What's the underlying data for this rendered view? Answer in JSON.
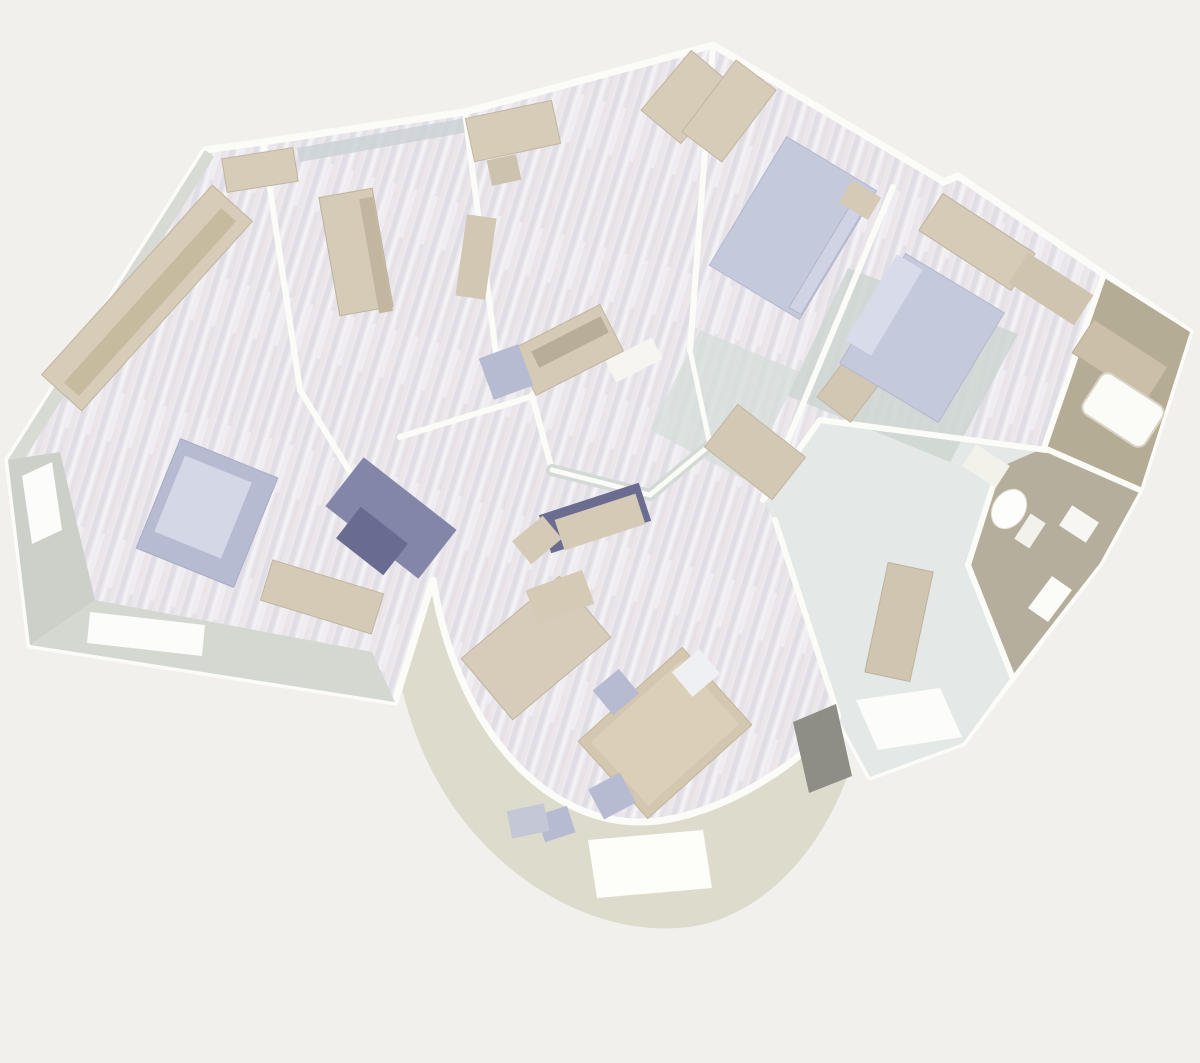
{
  "scene": {
    "label": "3D rendered bird's-eye floor plan of an apartment with curved terrace",
    "background": "#f2f0ec"
  },
  "palette": {
    "background": "#f2f0ec",
    "wall_white": "#fbfbf8",
    "wall_face_gray": "#ccd0c9",
    "wall_face_blue": "#c9d1d5",
    "floor_base": "#ebe9ed",
    "floor_streak_dark": "#e0dee4",
    "floor_streak_light": "#f3f2f5",
    "terrace_floor": "#dddbcc",
    "hall_floor": "#e4e8e6",
    "tile_taupe": "#b6ae9c",
    "furniture_beige": "#d7ccb8",
    "furniture_beige_dark": "#bfb4a0",
    "bed_lavender": "#c5c9dc",
    "bed_lavender_light": "#d8dbe9",
    "navy": "#8386a9",
    "navy_dark": "#696b90",
    "rug_green": "#ccd5cf",
    "fixture_white": "#fdfdfb",
    "door_gray": "#8e8e86"
  },
  "shapes": [
    {
      "n": "terrace-floor",
      "t": "path",
      "d": "M390,610 C398,712 430,793 495,855 C565,920 645,938 705,924 C765,908 818,856 848,775 L835,716 C788,772 705,820 640,820 C540,820 460,722 436,585 Z",
      "f": "#dddbcc"
    },
    {
      "n": "terrace-doormat",
      "t": "polygon",
      "pts": [
        [
          588,
          840
        ],
        [
          703,
          830
        ],
        [
          712,
          888
        ],
        [
          597,
          898
        ]
      ],
      "f": "#fdfdfa"
    },
    {
      "n": "building-footprint-floor",
      "t": "path",
      "d": "M8,460 L205,150 L263,142 L465,112 L713,45 L944,182 L958,176 L1190,332 L1140,490 L1100,563 L963,743 L870,777 L838,718 C790,775 705,822 640,822 C538,822 455,720 433,580 L395,702 L30,645 Z",
      "f": "url(#wood)",
      "s": "#fbfbf8",
      "sw": 7
    },
    {
      "n": "hallway-floor",
      "t": "polygon",
      "pts": [
        [
          820,
          420
        ],
        [
          1046,
          450
        ],
        [
          998,
          468
        ],
        [
          968,
          565
        ],
        [
          1012,
          676
        ],
        [
          963,
          743
        ],
        [
          870,
          777
        ],
        [
          838,
          718
        ],
        [
          780,
          530
        ],
        [
          763,
          500
        ]
      ],
      "f": "#e4e8e6"
    },
    {
      "n": "wc-floor",
      "t": "polygon",
      "pts": [
        [
          998,
          468
        ],
        [
          1044,
          448
        ],
        [
          1140,
          490
        ],
        [
          1100,
          563
        ],
        [
          1012,
          676
        ],
        [
          968,
          565
        ]
      ],
      "f": "#b6ae9c"
    },
    {
      "n": "bathroom-floor",
      "t": "polygon",
      "pts": [
        [
          1103,
          277
        ],
        [
          1190,
          332
        ],
        [
          1140,
          490
        ],
        [
          1044,
          448
        ]
      ],
      "f": "#b5ac96"
    },
    {
      "n": "master-bedroom-rug",
      "t": "polygon",
      "pts": [
        [
          700,
          330
        ],
        [
          800,
          372
        ],
        [
          745,
          480
        ],
        [
          650,
          430
        ]
      ],
      "f": "#d6ded9",
      "o": 0.75
    },
    {
      "n": "second-bedroom-rug",
      "t": "polygon",
      "pts": [
        [
          848,
          268
        ],
        [
          1018,
          334
        ],
        [
          950,
          462
        ],
        [
          788,
          396
        ]
      ],
      "f": "#ccd5cf",
      "o": 0.8
    },
    {
      "n": "wall-face-top-left",
      "t": "polygon",
      "pts": [
        [
          8,
          460
        ],
        [
          205,
          150
        ],
        [
          214,
          157
        ],
        [
          20,
          466
        ]
      ],
      "f": "#d8dad4"
    },
    {
      "n": "wall-face-left",
      "t": "polygon",
      "pts": [
        [
          8,
          460
        ],
        [
          30,
          645
        ],
        [
          95,
          600
        ],
        [
          60,
          452
        ]
      ],
      "f": "#ccd0c9"
    },
    {
      "n": "wall-face-bottom",
      "t": "polygon",
      "pts": [
        [
          30,
          645
        ],
        [
          395,
          702
        ],
        [
          372,
          652
        ],
        [
          95,
          600
        ]
      ],
      "f": "#d5d7d1"
    },
    {
      "n": "wall-face-room2-top",
      "t": "polygon",
      "pts": [
        [
          297,
          148
        ],
        [
          465,
          118
        ],
        [
          468,
          132
        ],
        [
          300,
          162
        ]
      ],
      "f": "#c9d1d5",
      "o": 0.8
    },
    {
      "n": "window-left-wall",
      "t": "polygon",
      "pts": [
        [
          22,
          476
        ],
        [
          52,
          462
        ],
        [
          62,
          530
        ],
        [
          32,
          544
        ]
      ],
      "f": "#fcfcfa"
    },
    {
      "n": "window-bottom-wall",
      "t": "polygon",
      "pts": [
        [
          90,
          612
        ],
        [
          205,
          625
        ],
        [
          202,
          656
        ],
        [
          87,
          643
        ]
      ],
      "f": "#fcfcfa"
    },
    {
      "n": "wall-living-room2",
      "t": "polyline",
      "pts": [
        [
          263,
          142
        ],
        [
          300,
          390
        ],
        [
          407,
          565
        ]
      ],
      "s": "#fbfbf8",
      "sw": 6
    },
    {
      "n": "wall-room2-office",
      "t": "polyline",
      "pts": [
        [
          465,
          112
        ],
        [
          500,
          385
        ]
      ],
      "s": "#fbfbf8",
      "sw": 6
    },
    {
      "n": "wall-office-master",
      "t": "polyline",
      "pts": [
        [
          713,
          45
        ],
        [
          690,
          350
        ]
      ],
      "s": "#fbfbf8",
      "sw": 6
    },
    {
      "n": "wall-master-bedroom2",
      "t": "polyline",
      "pts": [
        [
          893,
          187
        ],
        [
          763,
          500
        ]
      ],
      "s": "#fbfbf8",
      "sw": 6
    },
    {
      "n": "wall-bedroom2-hub",
      "t": "polyline",
      "pts": [
        [
          763,
          500
        ],
        [
          820,
          420
        ]
      ],
      "s": "#fbfbf8",
      "sw": 6
    },
    {
      "n": "wall-bedroom2-hall",
      "t": "polyline",
      "pts": [
        [
          820,
          420
        ],
        [
          1046,
          450
        ]
      ],
      "s": "#fbfbf8",
      "sw": 6
    },
    {
      "n": "wall-bedroom2-bathroom",
      "t": "polyline",
      "pts": [
        [
          1103,
          277
        ],
        [
          1044,
          448
        ]
      ],
      "s": "#fbfbf8",
      "sw": 6
    },
    {
      "n": "wall-bathroom-wc",
      "t": "polyline",
      "pts": [
        [
          1044,
          448
        ],
        [
          1140,
          490
        ]
      ],
      "s": "#fbfbf8",
      "sw": 6
    },
    {
      "n": "wall-wc-left",
      "t": "polyline",
      "pts": [
        [
          998,
          470
        ],
        [
          968,
          565
        ]
      ],
      "s": "#fbfbf8",
      "sw": 6
    },
    {
      "n": "wall-wc-bottom",
      "t": "polyline",
      "pts": [
        [
          968,
          565
        ],
        [
          1012,
          676
        ]
      ],
      "s": "#fbfbf8",
      "sw": 6
    },
    {
      "n": "wall-hall-roundroom",
      "t": "polyline",
      "pts": [
        [
          775,
          520
        ],
        [
          838,
          715
        ]
      ],
      "s": "#fbfbf8",
      "sw": 6
    },
    {
      "n": "wall-hub-1",
      "t": "polyline",
      "pts": [
        [
          400,
          437
        ],
        [
          530,
          397
        ]
      ],
      "s": "#fbfbf8",
      "sw": 6
    },
    {
      "n": "wall-hub-2",
      "t": "polyline",
      "pts": [
        [
          532,
          395
        ],
        [
          552,
          470
        ]
      ],
      "s": "#fbfbf8",
      "sw": 6
    },
    {
      "n": "wall-hub-3-face",
      "t": "polyline",
      "pts": [
        [
          552,
          470
        ],
        [
          650,
          495
        ],
        [
          710,
          445
        ]
      ],
      "s": "#d3d9d5",
      "sw": 12
    },
    {
      "n": "wall-hub-3",
      "t": "polyline",
      "pts": [
        [
          552,
          470
        ],
        [
          650,
          495
        ],
        [
          710,
          445
        ]
      ],
      "s": "#fbfbf8",
      "sw": 5
    },
    {
      "n": "wall-hub-4",
      "t": "polyline",
      "pts": [
        [
          710,
          445
        ],
        [
          690,
          350
        ]
      ],
      "s": "#fbfbf8",
      "sw": 5
    },
    {
      "n": "wall-bay-curved",
      "t": "path",
      "d": "M838,718 C790,775 705,822 640,822 C538,822 455,720 433,580",
      "s": "#fbfbf8",
      "sw": 6,
      "f": "none"
    },
    {
      "n": "living-sideboard",
      "t": "rect",
      "cx": 147,
      "cy": 298,
      "w": 255,
      "h": 54,
      "rot": -48,
      "f": "#d7ccb8",
      "s": "#bfb4a0",
      "sw": 1
    },
    {
      "n": "living-sideboard-top",
      "t": "rect",
      "cx": 150,
      "cy": 302,
      "w": 235,
      "h": 20,
      "rot": -48,
      "f": "#c6ba9f"
    },
    {
      "n": "living-cabinet",
      "t": "rect",
      "cx": 260,
      "cy": 170,
      "w": 72,
      "h": 34,
      "rot": -9,
      "f": "#d7ccb8",
      "s": "#bfb4a0",
      "sw": 1
    },
    {
      "n": "living-armchair",
      "t": "rect",
      "cx": 207,
      "cy": 513,
      "w": 105,
      "h": 118,
      "rot": 22,
      "f": "#b7bbd2",
      "s": "#a6aac4",
      "sw": 1
    },
    {
      "n": "living-armchair-cushion",
      "t": "rect",
      "cx": 203,
      "cy": 507,
      "w": 72,
      "h": 82,
      "rot": 22,
      "f": "#d4d7e6"
    },
    {
      "n": "living-navy-sofa",
      "t": "rect",
      "cx": 391,
      "cy": 518,
      "w": 118,
      "h": 62,
      "rot": 38,
      "f": "#8386a9"
    },
    {
      "n": "living-navy-sofa-dark",
      "t": "rect",
      "cx": 372,
      "cy": 541,
      "w": 60,
      "h": 40,
      "rot": 38,
      "f": "#696b90"
    },
    {
      "n": "living-desk",
      "t": "rect",
      "cx": 322,
      "cy": 597,
      "w": 116,
      "h": 42,
      "rot": 17,
      "f": "#d5cab6",
      "s": "#c1b6a2",
      "sw": 1
    },
    {
      "n": "room2-wardrobe",
      "t": "rect",
      "cx": 356,
      "cy": 252,
      "w": 54,
      "h": 120,
      "rot": -10,
      "f": "#d6cbb7",
      "s": "#bdb29d",
      "sw": 1
    },
    {
      "n": "room2-wardrobe-side",
      "t": "rect",
      "cx": 376,
      "cy": 255,
      "w": 14,
      "h": 116,
      "rot": -10,
      "f": "#c2b6a0"
    },
    {
      "n": "office-desk",
      "t": "rect",
      "cx": 513,
      "cy": 131,
      "w": 88,
      "h": 44,
      "rot": -12,
      "f": "#d7ccb8",
      "s": "#c1b6a2",
      "sw": 1
    },
    {
      "n": "office-stool",
      "t": "rect",
      "cx": 504,
      "cy": 170,
      "w": 30,
      "h": 26,
      "rot": -12,
      "f": "#cdc2ad"
    },
    {
      "n": "office-wardrobe",
      "t": "rect",
      "cx": 686,
      "cy": 97,
      "w": 52,
      "h": 78,
      "rot": 40,
      "f": "#d7ccb8",
      "s": "#c1b6a2",
      "sw": 1
    },
    {
      "n": "office-shelf",
      "t": "rect",
      "cx": 476,
      "cy": 257,
      "w": 30,
      "h": 82,
      "rot": 8,
      "f": "#d2c7b3"
    },
    {
      "n": "office-desk-2",
      "t": "rect",
      "cx": 568,
      "cy": 350,
      "w": 98,
      "h": 52,
      "rot": -27,
      "f": "#d5cab6",
      "s": "#c1b6a2",
      "sw": 1
    },
    {
      "n": "office-desk-2-hatch",
      "t": "rect",
      "cx": 570,
      "cy": 342,
      "w": 78,
      "h": 18,
      "rot": -27,
      "f": "#b7ad98"
    },
    {
      "n": "office-bench",
      "t": "rect",
      "cx": 634,
      "cy": 360,
      "w": 52,
      "h": 24,
      "rot": -27,
      "f": "#f6f5f1"
    },
    {
      "n": "office-seat",
      "t": "rect",
      "cx": 506,
      "cy": 372,
      "w": 42,
      "h": 44,
      "rot": -20,
      "f": "#b7bbd2"
    },
    {
      "n": "master-bed",
      "t": "rect",
      "cx": 793,
      "cy": 228,
      "w": 105,
      "h": 150,
      "rot": 31,
      "f": "#c5c9dc",
      "s": "#b3b7ce",
      "sw": 1
    },
    {
      "n": "master-bed-blanket-roll",
      "t": "rect",
      "cx": 831,
      "cy": 251,
      "w": 14,
      "h": 140,
      "rot": 31,
      "f": "#cfd3e3",
      "s": "#b3b7ce",
      "sw": 1
    },
    {
      "n": "master-wardrobe",
      "t": "rect",
      "cx": 729,
      "cy": 111,
      "w": 50,
      "h": 90,
      "rot": 37,
      "f": "#d7ccb8",
      "s": "#c1b6a2",
      "sw": 1
    },
    {
      "n": "master-nightstand",
      "t": "rect",
      "cx": 860,
      "cy": 200,
      "w": 34,
      "h": 26,
      "rot": 31,
      "f": "#d5cab6"
    },
    {
      "n": "master-dresser",
      "t": "rect",
      "cx": 853,
      "cy": 384,
      "w": 42,
      "h": 64,
      "rot": 37,
      "f": "#d2c7b3",
      "s": "#c1b6a2",
      "sw": 1
    },
    {
      "n": "bedroom2-bed",
      "t": "rect",
      "cx": 922,
      "cy": 338,
      "w": 115,
      "h": 128,
      "rot": 31,
      "f": "#c5c9dc",
      "s": "#b3b7ce",
      "sw": 1
    },
    {
      "n": "bedroom2-pillow",
      "t": "rect",
      "cx": 884,
      "cy": 305,
      "w": 30,
      "h": 100,
      "rot": 31,
      "f": "#d8dbe9"
    },
    {
      "n": "bedroom2-wardrobe",
      "t": "rect",
      "cx": 977,
      "cy": 242,
      "w": 110,
      "h": 44,
      "rot": 33,
      "f": "#d6cbb7",
      "s": "#bdb29d",
      "sw": 1
    },
    {
      "n": "bedroom2-cabinet",
      "t": "rect",
      "cx": 1051,
      "cy": 289,
      "w": 78,
      "h": 36,
      "rot": 33,
      "f": "#cfc4b0"
    },
    {
      "n": "bathroom-counter",
      "t": "rect",
      "cx": 1120,
      "cy": 360,
      "w": 88,
      "h": 40,
      "rot": 33,
      "f": "#cbbfa8",
      "s": "#b9ad95",
      "sw": 1
    },
    {
      "n": "bathtub",
      "t": "rect",
      "cx": 1123,
      "cy": 410,
      "w": 74,
      "h": 48,
      "rot": 33,
      "crx": 9,
      "f": "#fbfbf8",
      "s": "#d9d3c5",
      "sw": 2
    },
    {
      "n": "wc-counter",
      "t": "rect",
      "cx": 986,
      "cy": 466,
      "w": 40,
      "h": 26,
      "rot": 33,
      "f": "#f2f1ea"
    },
    {
      "n": "wc-toilet-bowl",
      "t": "ellipse",
      "cx": 1009,
      "cy": 509,
      "erx": 16,
      "ery": 21,
      "rot": 33,
      "f": "#fdfdfc",
      "s": "#e0ddd3",
      "sw": 1
    },
    {
      "n": "wc-toilet-tank",
      "t": "rect",
      "cx": 1030,
      "cy": 531,
      "w": 18,
      "h": 30,
      "rot": 33,
      "f": "#f2f1ec"
    },
    {
      "n": "wc-sink",
      "t": "rect",
      "cx": 1079,
      "cy": 524,
      "w": 32,
      "h": 24,
      "rot": 33,
      "f": "#f7f6f2"
    },
    {
      "n": "hall-bench",
      "t": "rect",
      "cx": 899,
      "cy": 622,
      "w": 46,
      "h": 112,
      "rot": 12,
      "f": "#d0c5b1",
      "s": "#bdb29d",
      "sw": 1
    },
    {
      "n": "hall-window",
      "t": "polygon",
      "pts": [
        [
          1028,
          608
        ],
        [
          1052,
          576
        ],
        [
          1072,
          590
        ],
        [
          1048,
          622
        ]
      ],
      "f": "#fbfbf8"
    },
    {
      "n": "roundroom-desk",
      "t": "rect",
      "cx": 536,
      "cy": 648,
      "w": 128,
      "h": 80,
      "rot": -40,
      "f": "#d7ccb9",
      "s": "#bfb4a0",
      "sw": 1
    },
    {
      "n": "roundroom-table",
      "t": "rect",
      "cx": 665,
      "cy": 733,
      "w": 140,
      "h": 104,
      "rot": -42,
      "f": "#d4c7b0",
      "s": "#c2b59e",
      "sw": 1
    },
    {
      "n": "roundroom-table-top",
      "t": "rect",
      "cx": 665,
      "cy": 733,
      "w": 122,
      "h": 86,
      "rot": -42,
      "f": "#dccfb8"
    },
    {
      "n": "roundroom-chair-1",
      "t": "rect",
      "cx": 616,
      "cy": 692,
      "w": 34,
      "h": 32,
      "rot": -40,
      "f": "#b7bbd2"
    },
    {
      "n": "roundroom-chair-2",
      "t": "rect",
      "cx": 612,
      "cy": 796,
      "w": 36,
      "h": 34,
      "rot": -28,
      "f": "#b7bbd2"
    },
    {
      "n": "roundroom-chair-3",
      "t": "rect",
      "cx": 556,
      "cy": 824,
      "w": 32,
      "h": 28,
      "rot": -18,
      "f": "#b7bbd2"
    },
    {
      "n": "roundroom-chair-4",
      "t": "rect",
      "cx": 696,
      "cy": 673,
      "w": 36,
      "h": 32,
      "rot": -40,
      "f": "#eef0f4"
    },
    {
      "n": "roundroom-stool",
      "t": "rect",
      "cx": 528,
      "cy": 821,
      "w": 38,
      "h": 28,
      "rot": -12,
      "f": "#c3c7d6"
    },
    {
      "n": "hub-navy-cabinet",
      "t": "rect",
      "cx": 595,
      "cy": 518,
      "w": 105,
      "h": 40,
      "rot": -18,
      "f": "#6a6c90"
    },
    {
      "n": "hub-beige-cabinet",
      "t": "rect",
      "cx": 600,
      "cy": 522,
      "w": 85,
      "h": 32,
      "rot": -18,
      "f": "#d5cab6"
    },
    {
      "n": "hub-cabinet-1",
      "t": "rect",
      "cx": 537,
      "cy": 540,
      "w": 40,
      "h": 30,
      "rot": -40,
      "f": "#d5cab6"
    },
    {
      "n": "hub-cabinet-2",
      "t": "rect",
      "cx": 560,
      "cy": 597,
      "w": 60,
      "h": 36,
      "rot": -20,
      "f": "#d5cab6"
    },
    {
      "n": "hub-desk-right",
      "t": "rect",
      "cx": 755,
      "cy": 452,
      "w": 86,
      "h": 54,
      "rot": 38,
      "f": "#d3c8b4",
      "s": "#c1b6a2",
      "sw": 1
    },
    {
      "n": "entry-doormat",
      "t": "polygon",
      "pts": [
        [
          856,
          700
        ],
        [
          940,
          688
        ],
        [
          962,
          737
        ],
        [
          878,
          750
        ]
      ],
      "f": "#fcfcfa"
    },
    {
      "n": "entry-door-panel",
      "t": "polygon",
      "pts": [
        [
          793,
          722
        ],
        [
          836,
          704
        ],
        [
          852,
          776
        ],
        [
          809,
          793
        ]
      ],
      "f": "#8e8e86"
    }
  ]
}
